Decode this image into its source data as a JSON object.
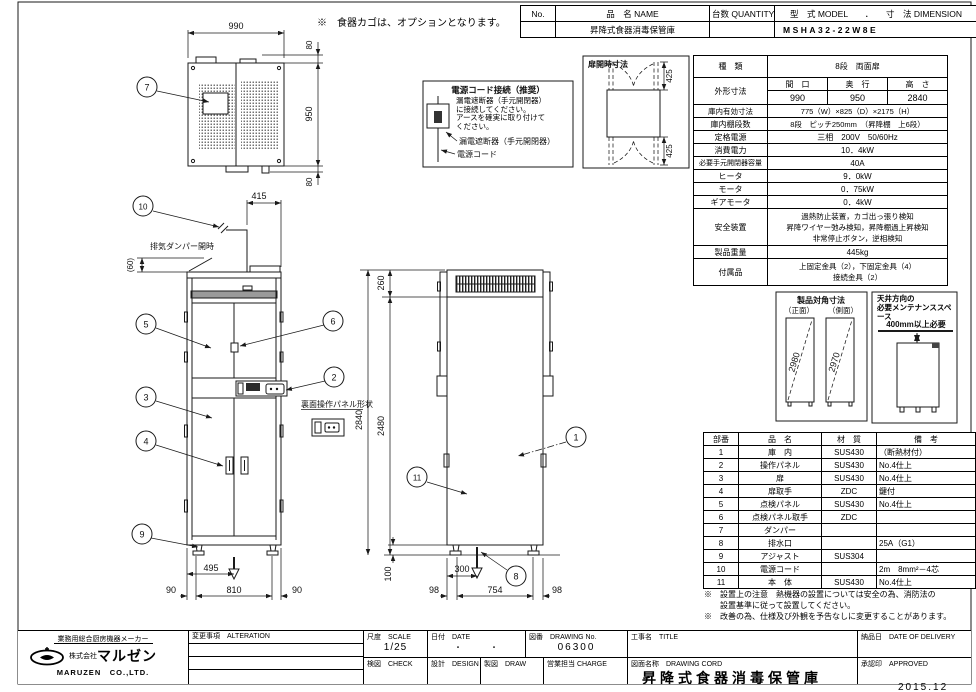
{
  "sheet": {
    "bottom_date": "2015.12"
  },
  "notes": {
    "option_note": "※　食器カゴは、オプションとなります。",
    "install_note": "※　設置上の注意　熱機器の設置については安全の為、消防法の\n　　設置基準に従って設置してください。",
    "change_note": "※　改善の為、仕様及び外観を予告なしに変更することがあります。"
  },
  "header_table": {
    "no_label": "No.",
    "name_label": "品　名 NAME",
    "qty_label": "台数 QUANTITY",
    "model_dim_label": "型　式 MODEL　　．　　寸　法 DIMENSION",
    "name_value": "昇降式食器消毒保管庫",
    "model_value": "MSHA32-22W8E"
  },
  "spec_table": {
    "kind_label": "種　類",
    "kind_value": "8段　両面扉",
    "outer_label": "外形寸法",
    "outer_cols": [
      "間　口",
      "奥　行",
      "高　さ"
    ],
    "outer_vals": [
      "990",
      "950",
      "2840"
    ],
    "rows": [
      {
        "label": "庫内有効寸法",
        "value": "775（W）×825（D）×2175（H）"
      },
      {
        "label": "庫内棚段数",
        "value": "8段　ピッチ250mm　（昇降棚　上6段）"
      },
      {
        "label": "定格電源",
        "value": "三相　200V　50/60Hz"
      },
      {
        "label": "消費電力",
        "value": "10．4kW"
      },
      {
        "label": "必要手元開閉器容量",
        "value": "40A"
      },
      {
        "label": "ヒータ",
        "value": "9．0kW"
      },
      {
        "label": "モータ",
        "value": "0．75kW"
      },
      {
        "label": "ギアモータ",
        "value": "0．4kW"
      },
      {
        "label": "安全装置",
        "value": "過熱防止装置，カゴ出っ張り検知\n昇降ワイヤー弛み検知，昇降棚過上昇検知\n非常停止ボタン，逆相検知"
      },
      {
        "label": "製品重量",
        "value": "445kg"
      },
      {
        "label": "付属品",
        "value": "上固定金具（2），下固定金具（4）\n接続金具（2）"
      }
    ]
  },
  "parts_table": {
    "headers": [
      "部番",
      "品　名",
      "材　質",
      "備　考"
    ],
    "rows": [
      {
        "no": "1",
        "name": "庫　内",
        "material": "SUS430",
        "note": "（断熱材付）"
      },
      {
        "no": "2",
        "name": "操作パネル",
        "material": "SUS430",
        "note": "No.4仕上"
      },
      {
        "no": "3",
        "name": "扉",
        "material": "SUS430",
        "note": "No.4仕上"
      },
      {
        "no": "4",
        "name": "扉取手",
        "material": "ZDC",
        "note": "鍵付"
      },
      {
        "no": "5",
        "name": "点検パネル",
        "material": "SUS430",
        "note": "No.4仕上"
      },
      {
        "no": "6",
        "name": "点検パネル取手",
        "material": "ZDC",
        "note": ""
      },
      {
        "no": "7",
        "name": "ダンパー",
        "material": "",
        "note": ""
      },
      {
        "no": "8",
        "name": "排水口",
        "material": "",
        "note": "25A（G1）"
      },
      {
        "no": "9",
        "name": "アジャスト",
        "material": "SUS304",
        "note": ""
      },
      {
        "no": "10",
        "name": "電源コード",
        "material": "",
        "note": "2m　8mm²－4芯"
      },
      {
        "no": "11",
        "name": "本　体",
        "material": "SUS430",
        "note": "No.4仕上"
      }
    ]
  },
  "power_box": {
    "title": "電源コード接続（推奨）",
    "body": "漏電遮断器（手元開閉器）\nに接続してください。\nアースを確実に取り付けて\nください。",
    "breaker_label": "漏電遮断器（手元開閉器）",
    "cord_label": "電源コード"
  },
  "door_open_box": {
    "title": "扉開時寸法",
    "top_dim": "425",
    "bottom_dim": "425"
  },
  "diagonal_box": {
    "title": "製品対角寸法",
    "front_label": "（正面）",
    "side_label": "（側面）",
    "front_value": "2980",
    "side_value": "2970"
  },
  "maintenance_box": {
    "title": "天井方向の\n必要メンテナンススペース",
    "value": "400mm以上必要"
  },
  "drawing_labels": {
    "exhaust_damper": "排気ダンパー開時",
    "rear_panel": "裏面操作パネル形状"
  },
  "dims": {
    "top_width": "990",
    "top_top": "80",
    "top_depth": "950",
    "top_bottom": "80",
    "cord_offset": "415",
    "damper_open": "(60)",
    "front_height": "2840",
    "body_height": "2480",
    "vent_h": "260",
    "base_h": "100",
    "drain_front": "495",
    "front_left": "90",
    "front_center": "810",
    "front_right": "90",
    "drain_side": "300",
    "side_left": "98",
    "side_center": "754",
    "side_right": "98"
  },
  "callouts": [
    "1",
    "2",
    "3",
    "4",
    "5",
    "6",
    "7",
    "8",
    "9",
    "10",
    "11"
  ],
  "titleblock": {
    "maker_tagline": "業務用総合厨房機器メーカー",
    "maker_name_prefix": "株式会社",
    "maker_name": "マルゼン",
    "maker_en": "MARUZEN　CO.,LTD.",
    "alteration_label": "変更事項　ALTERATION",
    "scale_label": "尺度　SCALE",
    "scale_value": "1/25",
    "date_label": "日付　DATE",
    "date_value": "・　　　・",
    "check_label": "検図　CHECK",
    "design_label": "設計　DESIGN",
    "draw_label": "製図　DRAW",
    "charge_label": "営業担当 CHARGE",
    "drawing_no_label": "図番　DRAWING No.",
    "drawing_no_value": "06300",
    "title_label": "工事名　TITLE",
    "drawing_name_label": "図面名称　DRAWING CORD",
    "drawing_name_value": "昇降式食器消毒保管庫",
    "delivery_label": "納品日　DATE OF DELIVERY",
    "approved_label": "承認印　APPROVED"
  }
}
